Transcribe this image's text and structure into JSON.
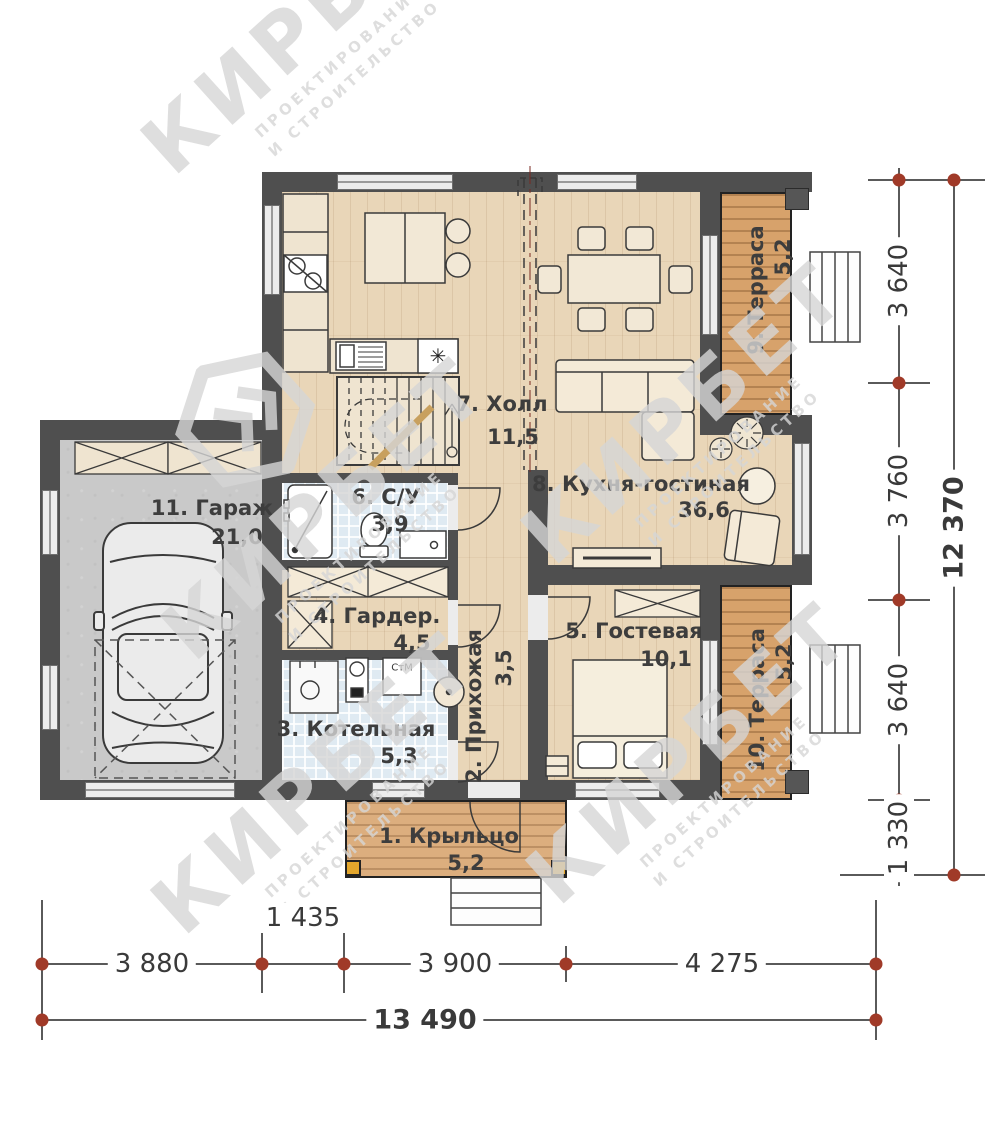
{
  "watermark": {
    "brand": "КИРБЕТ",
    "line1": "ПРОЕКТИРОВАНИЕ",
    "line2": "И СТРОИТЕЛЬСТВО"
  },
  "rooms": {
    "porch": {
      "name": "1. Крыльцо",
      "area": "5,2"
    },
    "hallway": {
      "name": "2. Прихожая",
      "area": "3,5"
    },
    "boiler": {
      "name": "3. Котельная",
      "area": "5,3"
    },
    "wardrobe": {
      "name": "4. Гардер.",
      "area": "4,5"
    },
    "guest": {
      "name": "5. Гостевая",
      "area": "10,1"
    },
    "bathroom": {
      "name": "6. С/У",
      "area": "3,9"
    },
    "hall": {
      "name": "7. Холл",
      "area": "11,5"
    },
    "kitchen_living": {
      "name": "8. Кухня-гостиная",
      "area": "36,6"
    },
    "terrace_top": {
      "name": "9. Терраса",
      "area": "5,2"
    },
    "terrace_bottom": {
      "name": "10. Терраса",
      "area": "5,2"
    },
    "garage": {
      "name": "11. Гараж",
      "area": "21,0"
    }
  },
  "fixtures": {
    "washing_machine": "СтМ",
    "fridge": "✳"
  },
  "dimensions": {
    "bottom": {
      "segments": [
        "3 880",
        "1 435",
        "3 900",
        "4 275"
      ],
      "total": "13 490"
    },
    "right": {
      "segments": [
        "3 640",
        "3 760",
        "3 640",
        "1 330"
      ],
      "total": "12 370"
    }
  },
  "colors": {
    "wall": "#4f4f4f",
    "wood_floor": "#e9d6b8",
    "terrace_wood": "#d7a26b",
    "tile": "#dfeaf2",
    "concrete": "#c9c9c9",
    "dimension_marker": "#a03a28"
  }
}
